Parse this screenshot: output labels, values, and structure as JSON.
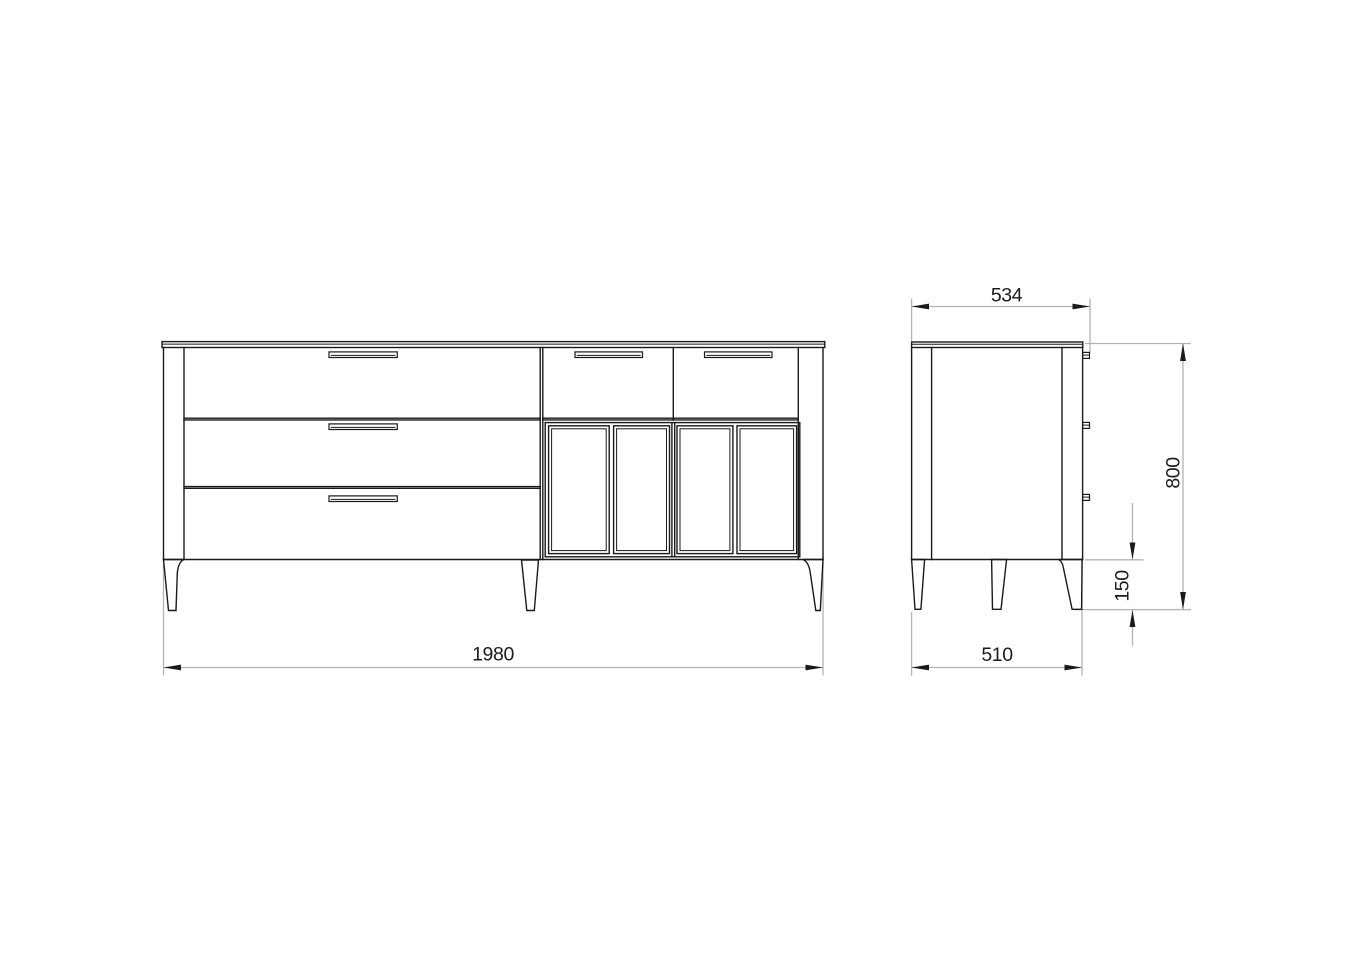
{
  "drawing": {
    "kind": "furniture-orthographic-views",
    "colors": {
      "outline": "#1a1a1a",
      "dimension_line": "#b3b3b3",
      "text": "#1c1c1c",
      "background": "#ffffff"
    },
    "front_view": {
      "large_drawers": 3,
      "small_drawers": 2,
      "door_panels": 4,
      "legs": 3,
      "handles": 5
    },
    "side_view": {
      "legs": 3,
      "handle_profiles": 3
    },
    "dims": {
      "width": {
        "value": "1980",
        "orientation": "horizontal",
        "view": "front"
      },
      "depth_overall": {
        "value": "534",
        "orientation": "horizontal",
        "view": "side"
      },
      "depth_body": {
        "value": "510",
        "orientation": "horizontal",
        "view": "side"
      },
      "height": {
        "value": "800",
        "orientation": "vertical",
        "view": "side"
      },
      "leg_height": {
        "value": "150",
        "orientation": "vertical",
        "view": "side"
      }
    }
  }
}
